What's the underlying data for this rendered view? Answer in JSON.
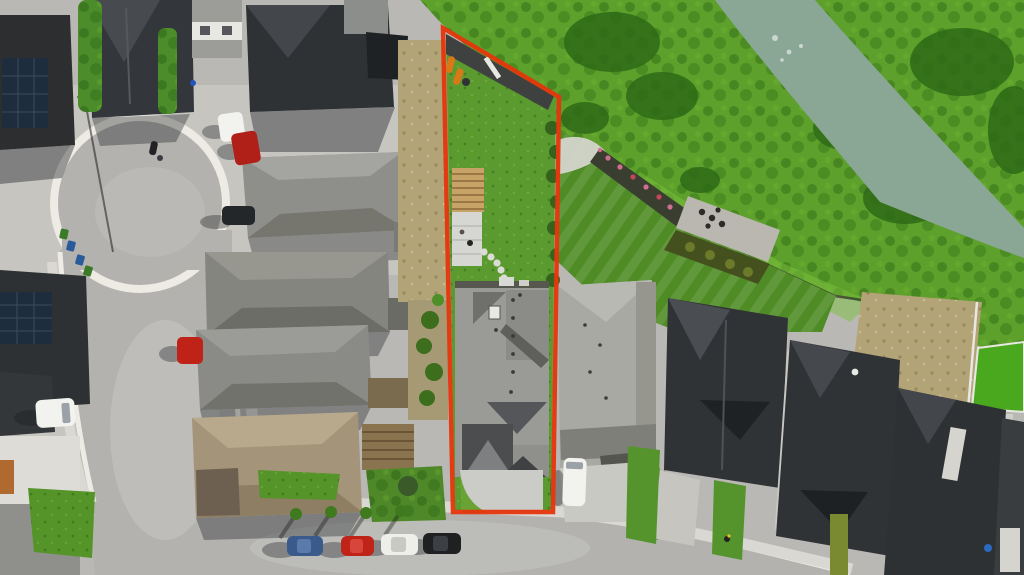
{
  "meta": {
    "type": "aerial-drone-photograph",
    "subject": "suburban residential lot outlined with a red property-boundary overlay, cul-de-sac street at left, greenbelt and canal at upper right"
  },
  "palette": {
    "accent": "#e5360d",
    "water": "#8aa796",
    "bankGreen": "#5da02b",
    "bankDark": "#2f6a16",
    "lawn": "#5a9a2e",
    "lawnLight": "#6aa335",
    "manicured": "#4f8c26",
    "turf": "#49a81e",
    "asphalt": "#b3b2ae",
    "concrete": "#c6c5c0",
    "curb": "#edebe4",
    "sidewalk": "#d9d8d2",
    "roofDark": "#303336",
    "roofCharcoal": "#2c2e30",
    "roofGrey": "#8e8e8a",
    "roofLight": "#9a9a96",
    "roofNeighbor": "#a9a9a3",
    "roofTan": "#a3947a",
    "dirt": "#b3a478",
    "pergola": "#c7a368",
    "patio": "#d6d6d2"
  },
  "annotations": {
    "property_boundary": {
      "shape": "polygon",
      "color": "#e5360d",
      "corners": [
        [
          443,
          28
        ],
        [
          559,
          97
        ],
        [
          553,
          512
        ],
        [
          453,
          512
        ]
      ]
    }
  },
  "objects": {
    "river": {
      "kind": "canal",
      "color": "#8aa796"
    },
    "subject_lot": [
      "rear-pathway",
      "kayaks",
      "lawn",
      "pergola",
      "patio",
      "stepping-stones",
      "grey-roof-house",
      "driveway"
    ],
    "vehicles": [
      {
        "name": "white-van-top",
        "color": "#f2f2ee"
      },
      {
        "name": "red-truck-top",
        "color": "#b02018"
      },
      {
        "name": "dark-car-driveway",
        "color": "#24272a"
      },
      {
        "name": "red-car-left-driveway",
        "color": "#bf2318"
      },
      {
        "name": "white-van-left",
        "color": "#f2f2ee"
      },
      {
        "name": "blue-car-street",
        "color": "#3a5a8c"
      },
      {
        "name": "red-car-street",
        "color": "#c02418"
      },
      {
        "name": "white-car-street",
        "color": "#eeeeea"
      },
      {
        "name": "black-car-street",
        "color": "#1e2022"
      },
      {
        "name": "white-van-neighbor",
        "color": "#f2f2ee"
      },
      {
        "name": "motorcycle",
        "color": "#222222"
      }
    ],
    "bins": [
      {
        "name": "green-bin-1",
        "color": "#3a7a28"
      },
      {
        "name": "blue-bin-1",
        "color": "#2a5a9a"
      },
      {
        "name": "blue-bin-2",
        "color": "#2a5a9a"
      },
      {
        "name": "green-bin-2",
        "color": "#3a7a28"
      },
      {
        "name": "blue-bin-row",
        "color": "#2a6ac0"
      }
    ]
  }
}
